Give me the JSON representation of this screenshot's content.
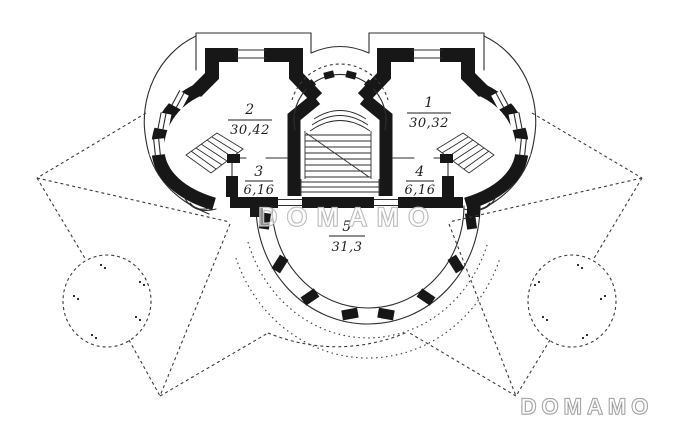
{
  "rooms": [
    {
      "number": "1",
      "area": "30,32"
    },
    {
      "number": "2",
      "area": "30,42"
    },
    {
      "number": "3",
      "area": "6,16"
    },
    {
      "number": "4",
      "area": "6,16"
    },
    {
      "number": "5",
      "area": "31,3"
    }
  ],
  "watermarks": {
    "center": "DOMAMO",
    "bottom_right": "DOMAMO"
  },
  "colors": {
    "paper": "#ffffff",
    "ink": "#2e2e2e",
    "wall": "#171717",
    "watermark_center": "#ababab",
    "watermark_corner": "#8d8d8d"
  }
}
